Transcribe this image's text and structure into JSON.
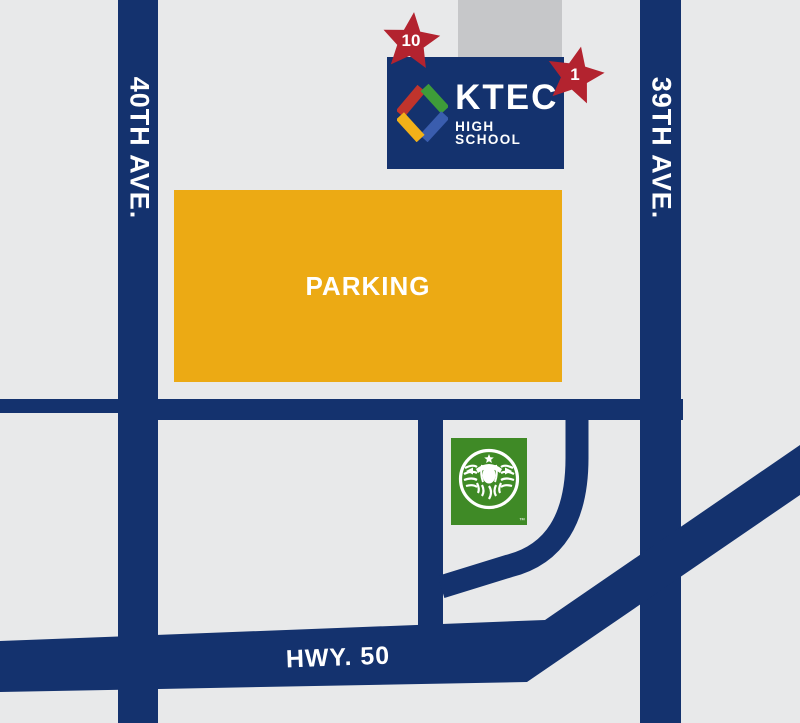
{
  "title": "KTEC High School area map",
  "colors": {
    "background": "#e8e9ea",
    "road": "#14326e",
    "parking": "#ecaa14",
    "building_gray": "#c6c7c9",
    "marker_red": "#b3232f",
    "starbucks_green": "#3f8a26",
    "text_white": "#ffffff",
    "logo_red": "#c0342c",
    "logo_green": "#3e9c39",
    "logo_yellow": "#f2b119",
    "logo_blue": "#3a5dae"
  },
  "streets": {
    "left_vertical": "40TH AVE.",
    "right_vertical": "39TH AVE.",
    "highway": "HWY. 50"
  },
  "parking": {
    "label": "PARKING"
  },
  "school_sign": {
    "name": "KTEC",
    "subtitle": "HIGH SCHOOL"
  },
  "markers": {
    "entrance_10": "10",
    "entrance_1": "1"
  },
  "starbucks": {
    "trademark": "™"
  }
}
